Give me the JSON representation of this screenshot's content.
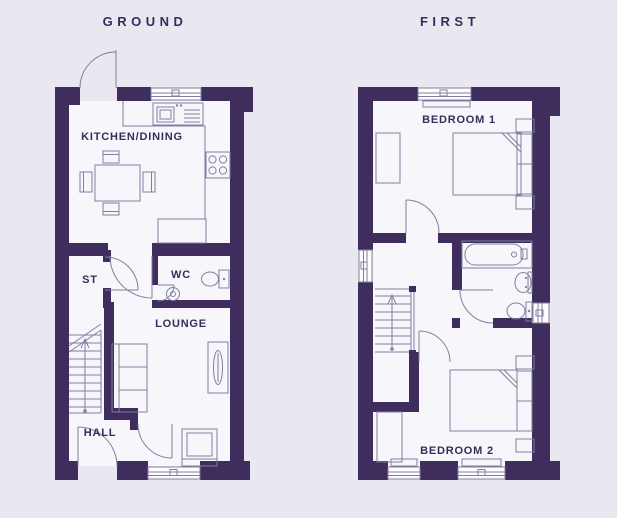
{
  "canvas": {
    "width": 617,
    "height": 518,
    "background": "#e9e7ef"
  },
  "colors": {
    "wall": "#3e2d5d",
    "line": "#837da0",
    "floor": "#f7f6fa",
    "text": "#372c5c",
    "window": "#fdfdfe",
    "bg": "#e9e7ef"
  },
  "titles": {
    "ground": "GROUND",
    "first": "FIRST"
  },
  "rooms": {
    "ground": {
      "kitchen_dining": "KITCHEN/DINING",
      "store": "ST",
      "wc": "WC",
      "lounge": "LOUNGE",
      "hall": "HALL"
    },
    "first": {
      "bedroom1": "BEDROOM 1",
      "bedroom2": "BEDROOM 2"
    }
  },
  "fixtures": {
    "ground": [
      "rear-door",
      "kitchen-window",
      "kitchen-sink",
      "kitchen-counter",
      "hob",
      "dining-table-with-chairs",
      "kitchen-door",
      "storage-door",
      "wc-door",
      "toilet",
      "basin",
      "stairs-up-arrow",
      "sofa",
      "side-table",
      "armchair",
      "lounge-door",
      "front-door",
      "lounge-window"
    ],
    "first": [
      "bedroom1-window",
      "wardrobe",
      "double-bed",
      "bedside-tables",
      "bedroom1-door",
      "landing-window",
      "bath",
      "basin",
      "toilet",
      "bathroom-window",
      "bathroom-door",
      "stairs-up-arrow",
      "bedroom2-door",
      "double-bed",
      "wardrobe",
      "bedroom2-windows"
    ]
  }
}
